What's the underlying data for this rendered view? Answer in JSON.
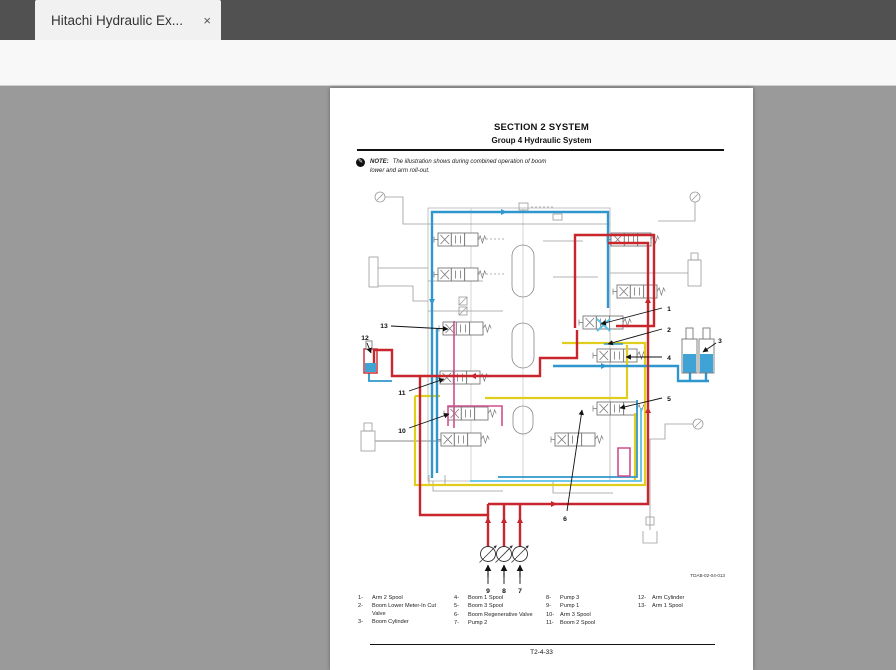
{
  "window": {
    "tab_title": "Hitachi Hydraulic Ex...",
    "close_label": "×"
  },
  "toolbar": {
    "page_current": "207",
    "page_total_label": "/ 455",
    "zoom_level": "46.7%"
  },
  "document": {
    "section_title": "SECTION 2 SYSTEM",
    "group_title": "Group 4 Hydraulic System",
    "note_label": "NOTE:",
    "note_text": "The illustration shows during combined operation of boom lower and arm roll-out.",
    "figure_ref": "TDAB-02-04-013",
    "page_footer": "T2-4-33"
  },
  "diagram": {
    "callouts": [
      "1",
      "2",
      "3",
      "4",
      "5",
      "6",
      "7",
      "8",
      "9",
      "10",
      "11",
      "12",
      "13"
    ]
  },
  "legend": {
    "items": [
      {
        "num": "1-",
        "label": "Arm 2 Spool"
      },
      {
        "num": "2-",
        "label": "Boom Lower Meter-In Cut Valve"
      },
      {
        "num": "3-",
        "label": "Boom Cylinder"
      },
      {
        "num": "4-",
        "label": "Boom 1 Spool"
      },
      {
        "num": "5-",
        "label": "Boom 3 Spool"
      },
      {
        "num": "6-",
        "label": "Boom Regenerative Valve"
      },
      {
        "num": "7-",
        "label": "Pump 2"
      },
      {
        "num": "8-",
        "label": "Pump 3"
      },
      {
        "num": "9-",
        "label": "Pump 1"
      },
      {
        "num": "10-",
        "label": "Arm 3 Spool"
      },
      {
        "num": "11-",
        "label": "Boom 2 Spool"
      },
      {
        "num": "12-",
        "label": "Arm Cylinder"
      },
      {
        "num": "13-",
        "label": "Arm 1 Spool"
      }
    ]
  },
  "colors": {
    "flow_red": "#c8252c",
    "flow_blue": "#2f97cd",
    "flow_yellow": "#e0cd1e",
    "flow_cyan": "#5bc0e8",
    "flow_magenta": "#cf4f8c",
    "circuit_gray": "#8a8a8a",
    "cursor_blue": "#2a7cd4"
  }
}
